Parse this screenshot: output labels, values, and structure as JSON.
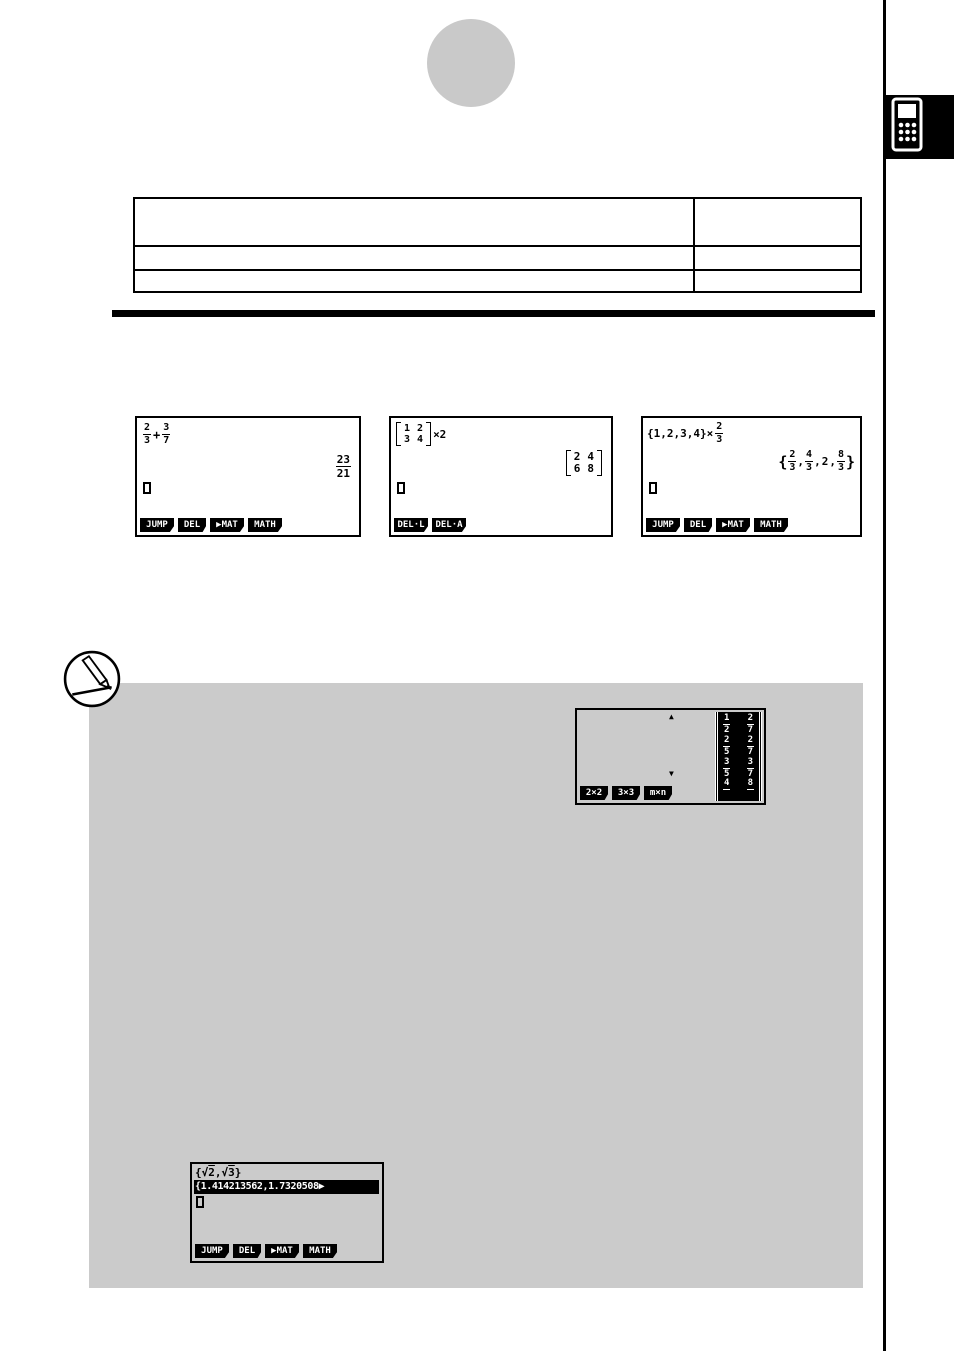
{
  "page": {
    "kind": "calculator manual page"
  },
  "screens": {
    "fraction_example": {
      "frac1": [
        "2",
        "3"
      ],
      "operator": "+",
      "frac2": [
        "3",
        "7"
      ],
      "result": [
        "23",
        "21"
      ],
      "fkeys": [
        "JUMP",
        "DEL",
        "▶MAT",
        "MATH"
      ]
    },
    "matrix_example": {
      "input": [
        [
          "1",
          "2"
        ],
        [
          "3",
          "4"
        ]
      ],
      "multiplier": "×2",
      "output": [
        [
          "2",
          "4"
        ],
        [
          "6",
          "8"
        ]
      ],
      "fkeys": [
        "DEL·L",
        "DEL·A"
      ]
    },
    "list_example": {
      "expression": "{1,2,3,4}×",
      "expr_frac": [
        "2",
        "3"
      ],
      "result_open": "{",
      "result_close": "}",
      "comma": ",",
      "result_frac1": [
        "2",
        "3"
      ],
      "result_frac2": [
        "4",
        "3"
      ],
      "result_int": "2",
      "result_frac3": [
        "8",
        "3"
      ],
      "fkeys": [
        "JUMP",
        "DEL",
        "▶MAT",
        "MATH"
      ]
    },
    "matrix_dim_example": {
      "up_arrow": "▲",
      "down_arrow": "▼",
      "rows": [
        [
          [
            "1",
            "2"
          ],
          [
            "2",
            "7"
          ]
        ],
        [
          [
            "2",
            "5"
          ],
          [
            "2",
            "7"
          ]
        ],
        [
          [
            "3",
            "5"
          ],
          [
            "3",
            "7"
          ]
        ]
      ],
      "partial_row": [
        "4",
        "8"
      ],
      "fkeys": [
        "2×2",
        "3×3",
        "m×n"
      ]
    },
    "sqrt_example": {
      "open": "{",
      "sqrt": "√",
      "v1": "2",
      "comma": ",",
      "v2": "3",
      "close": "}",
      "result_line": "{1.414213562,1.7320508▶",
      "fkeys": [
        "JUMP",
        "DEL",
        "▶MAT",
        "MATH"
      ]
    }
  }
}
